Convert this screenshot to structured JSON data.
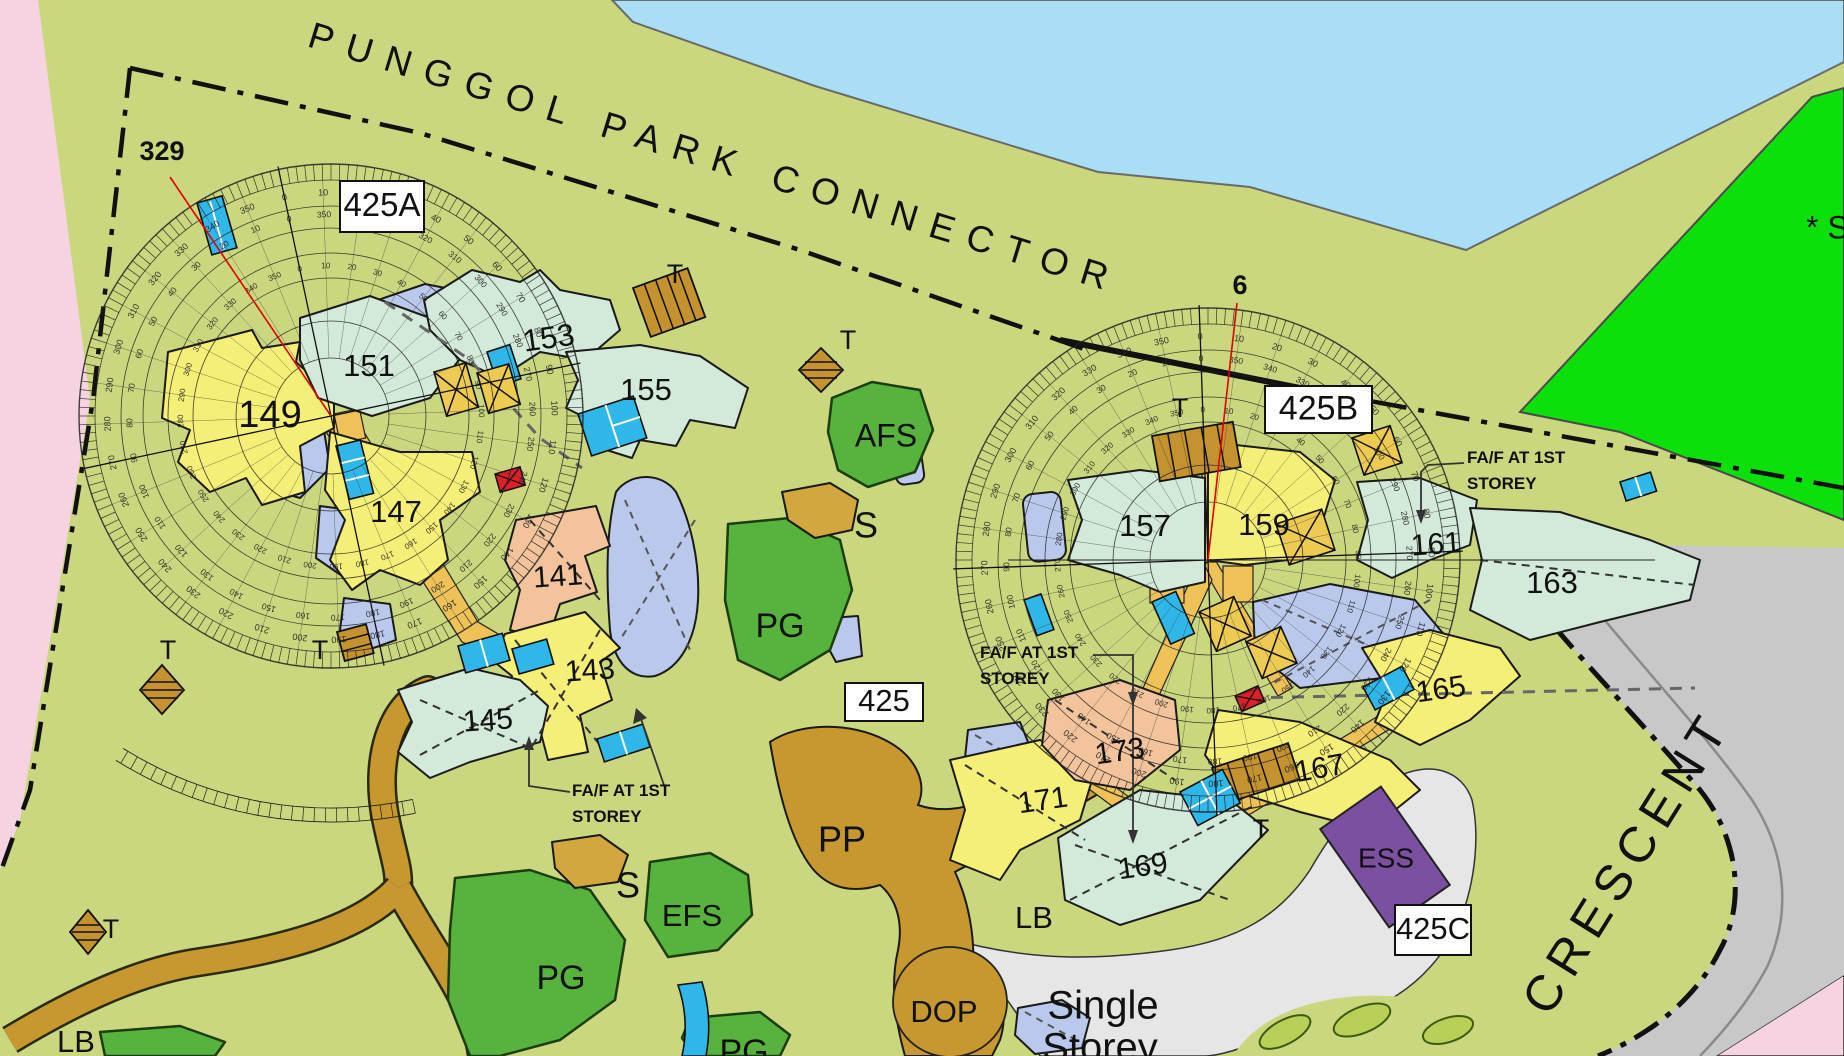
{
  "map": {
    "streets": {
      "punggol": {
        "text": "PUNGGOL PARK CONNECTOR",
        "x": 306,
        "y": 46,
        "rot": 17,
        "size": 37,
        "ls": 14
      },
      "crescent": {
        "text": "CRESCENT",
        "x": 1549,
        "y": 1018,
        "rot": -58,
        "size": 50,
        "ls": 9
      }
    },
    "survey_marks": [
      {
        "text": "329",
        "x": 162,
        "y": 160
      },
      {
        "text": "6",
        "x": 1240,
        "y": 294
      }
    ],
    "survey_lines": [
      {
        "x1": 331,
        "y1": 416,
        "x2": 170,
        "y2": 177
      },
      {
        "x1": 1208,
        "y1": 560,
        "x2": 1237,
        "y2": 303
      }
    ],
    "block_boxes": [
      {
        "text": "425A",
        "x": 340,
        "y": 181,
        "w": 84,
        "h": 51,
        "size": 33
      },
      {
        "text": "425B",
        "x": 1265,
        "y": 386,
        "w": 107,
        "h": 47,
        "size": 34
      },
      {
        "text": "425",
        "x": 845,
        "y": 683,
        "w": 78,
        "h": 38,
        "size": 31
      },
      {
        "text": "425C",
        "x": 1395,
        "y": 905,
        "w": 76,
        "h": 50,
        "size": 31
      }
    ],
    "building_labels": [
      {
        "text": "149",
        "x": 270,
        "y": 417,
        "size": 38,
        "rot": 0
      },
      {
        "text": "151",
        "x": 369,
        "y": 368,
        "size": 31,
        "rot": 0
      },
      {
        "text": "153",
        "x": 549,
        "y": 340,
        "size": 31,
        "rot": -8
      },
      {
        "text": "155",
        "x": 646,
        "y": 392,
        "size": 31,
        "rot": 0
      },
      {
        "text": "147",
        "x": 396,
        "y": 514,
        "size": 31,
        "rot": 0
      },
      {
        "text": "141",
        "x": 558,
        "y": 578,
        "size": 30,
        "rot": -4
      },
      {
        "text": "143",
        "x": 590,
        "y": 672,
        "size": 30,
        "rot": -4
      },
      {
        "text": "145",
        "x": 488,
        "y": 722,
        "size": 30,
        "rot": -4
      },
      {
        "text": "157",
        "x": 1145,
        "y": 528,
        "size": 31,
        "rot": 0
      },
      {
        "text": "159",
        "x": 1264,
        "y": 527,
        "size": 31,
        "rot": 0
      },
      {
        "text": "161",
        "x": 1436,
        "y": 546,
        "size": 30,
        "rot": -4
      },
      {
        "text": "163",
        "x": 1552,
        "y": 585,
        "size": 31,
        "rot": 0
      },
      {
        "text": "165",
        "x": 1441,
        "y": 691,
        "size": 30,
        "rot": -8
      },
      {
        "text": "167",
        "x": 1320,
        "y": 770,
        "size": 30,
        "rot": -10
      },
      {
        "text": "169",
        "x": 1143,
        "y": 868,
        "size": 30,
        "rot": -8
      },
      {
        "text": "171",
        "x": 1043,
        "y": 802,
        "size": 30,
        "rot": -8
      },
      {
        "text": "173",
        "x": 1120,
        "y": 753,
        "size": 30,
        "rot": -8
      }
    ],
    "amenity_labels": [
      {
        "text": "AFS",
        "x": 886,
        "y": 438,
        "size": 32
      },
      {
        "text": "S",
        "x": 866,
        "y": 528,
        "size": 36
      },
      {
        "text": "PG",
        "x": 780,
        "y": 628,
        "size": 34
      },
      {
        "text": "EFS",
        "x": 692,
        "y": 918,
        "size": 31
      },
      {
        "text": "S",
        "x": 628,
        "y": 888,
        "size": 36
      },
      {
        "text": "PG",
        "x": 561,
        "y": 980,
        "size": 34
      },
      {
        "text": "PG",
        "x": 744,
        "y": 1054,
        "size": 34
      },
      {
        "text": "PP",
        "x": 842,
        "y": 842,
        "size": 36
      },
      {
        "text": "DOP",
        "x": 944,
        "y": 1014,
        "size": 31
      },
      {
        "text": "LB",
        "x": 1034,
        "y": 920,
        "size": 31
      },
      {
        "text": "LB",
        "x": 76,
        "y": 1044,
        "size": 31
      },
      {
        "text": "ESS",
        "x": 1386,
        "y": 860,
        "size": 28
      }
    ],
    "shelter_labels": [
      {
        "text": "T",
        "x": 675,
        "y": 276
      },
      {
        "text": "T",
        "x": 848,
        "y": 342
      },
      {
        "text": "T",
        "x": 168,
        "y": 652
      },
      {
        "text": "T",
        "x": 320,
        "y": 652
      },
      {
        "text": "T",
        "x": 111,
        "y": 931
      },
      {
        "text": "T",
        "x": 1180,
        "y": 410
      },
      {
        "text": "T",
        "x": 1261,
        "y": 831
      }
    ],
    "area_labels": [
      {
        "text": "Single",
        "x": 1103,
        "y": 1008,
        "size": 40
      },
      {
        "text": "Storey",
        "x": 1100,
        "y": 1050,
        "size": 40
      },
      {
        "text": "* S",
        "x": 1806,
        "y": 230,
        "size": 32,
        "anchor": "start"
      }
    ],
    "notes": [
      {
        "line1": "FA/F AT 1ST",
        "line2": "STOREY",
        "x": 572,
        "y": 796
      },
      {
        "line1": "FA/F AT 1ST",
        "line2": "STOREY",
        "x": 980,
        "y": 658
      },
      {
        "line1": "FA/F AT 1ST",
        "line2": "STOREY",
        "x": 1467,
        "y": 463
      }
    ],
    "roses": [
      {
        "cx": 331,
        "cy": 416,
        "rotation": -12,
        "tick_band": [
          236,
          252
        ],
        "circles": [
          252,
          236,
          210,
          188,
          163,
          138,
          95,
          58
        ],
        "spoke_r": [
          58,
          236
        ],
        "axis_len": 255,
        "label_rings": [
          {
            "r": 223,
            "size": 9,
            "reverse": false
          },
          {
            "r": 201,
            "size": 8.5,
            "reverse": true
          },
          {
            "r": 150,
            "size": 8,
            "reverse": false
          }
        ],
        "extra_arcs": [
          {
            "r1": 392,
            "r2": 406,
            "b1": 180,
            "b2": 224,
            "step": 1.6
          }
        ]
      },
      {
        "cx": 1208,
        "cy": 560,
        "rotation": -2,
        "tick_band": [
          236,
          252
        ],
        "circles": [
          252,
          236,
          210,
          188,
          163,
          138,
          95,
          58
        ],
        "spoke_r": [
          58,
          236
        ],
        "axis_len": 255,
        "label_rings": [
          {
            "r": 223,
            "size": 9,
            "reverse": false
          },
          {
            "r": 201,
            "size": 8.5,
            "reverse": true
          },
          {
            "r": 150,
            "size": 8,
            "reverse": false
          }
        ],
        "extra_arcs": []
      }
    ],
    "degree_scale": {
      "step": 10,
      "max": 350
    },
    "colors": {
      "base_olive": "#cbd77e",
      "water_blue": "#aadef4",
      "open_green": "#0be00b",
      "pink_zone": "#f6d3e1",
      "road_gray": "#c8c8c8",
      "single_storey_gray": "#e6e6e6",
      "path_brown": "#c6982f",
      "mound_tan": "#d3a73f",
      "shelter_brown": "#c4922e",
      "walkway_orange": "#eec257",
      "building_yellow": "#f5ee77",
      "building_teal": "#d3e9d9",
      "building_peach": "#f3c49c",
      "landscape_lavender": "#bac8ec",
      "service_cyan": "#2fb7e9",
      "brace_yellow": "#edcb52",
      "alert_red": "#dc1f28",
      "ess_purple": "#7b50a0",
      "amenity_green": "#57b33e",
      "leaf_green": "#b9d058",
      "survey_red": "#e00000"
    }
  }
}
